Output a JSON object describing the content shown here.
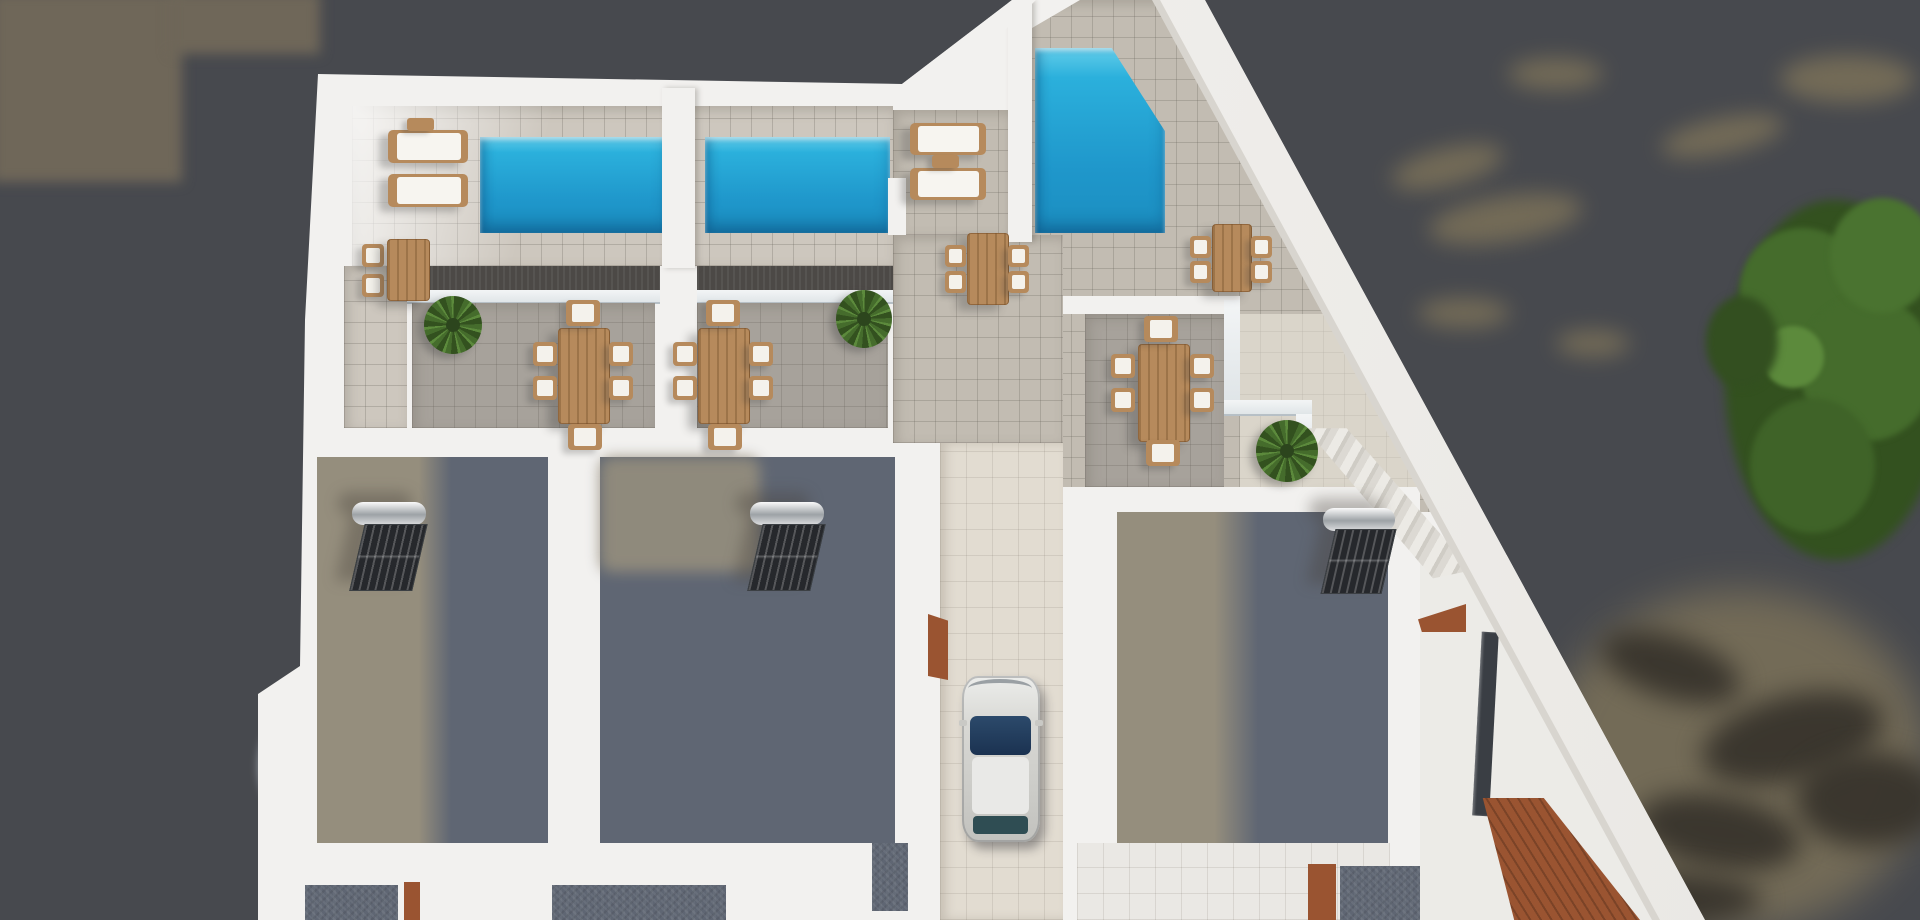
{
  "meta": {
    "title": "Aerial 3D architectural render of twin villas with rooftop pools, sun terraces, roof rooms with solar water heaters, a driveway with a parked car, and trees beside the plot",
    "width": 1920,
    "height": 920
  },
  "palette": {
    "ground": "#47494e",
    "ground_olive": "#6f6759",
    "shadow_blob": "#35312a",
    "olive_blob": "#7b7159",
    "wall": "#f2f1ef",
    "tile_light": "#cdc7be",
    "tile_mid": "#c2bcb2",
    "tile_gray": "#a7a29b",
    "tile_cream": "#e2dcd1",
    "tile_offwhite": "#eae8e4",
    "parapet": "#4c4946",
    "pool_hi": "#62cdea",
    "pool_mid": "#2bb0dc",
    "pool_deep": "#1f97cb",
    "gravel_lit": "#958e7d",
    "gravel_shadow": "#5f6673",
    "wood": "#b68a5c",
    "deck_brown": "#9a5431",
    "green_dark": "#33511f",
    "green_mid": "#456c2c",
    "green_light": "#5c8a3c",
    "car_body": "#d4d4d0",
    "car_glass": "#24415e",
    "sliver": "#3a3e44"
  },
  "scene": {
    "summary": {
      "pools": 3,
      "sun_loungers": 4,
      "dining_tables_six_seat": 3,
      "dining_tables_four_seat": 2,
      "bistro_sets": 1,
      "solar_water_heaters": 3,
      "cars": 1,
      "potted_palms": 3,
      "tree_cluster": "right edge of image"
    },
    "furniture_items": [
      {
        "type": "lounger",
        "x": 388,
        "y": 130,
        "w": 80,
        "h": 33
      },
      {
        "type": "lounger",
        "x": 388,
        "y": 174,
        "w": 80,
        "h": 33
      },
      {
        "type": "lounger",
        "x": 910,
        "y": 123,
        "w": 76,
        "h": 32
      },
      {
        "type": "lounger",
        "x": 910,
        "y": 168,
        "w": 76,
        "h": 32
      },
      {
        "type": "side-table",
        "x": 407,
        "y": 118,
        "w": 27,
        "h": 13
      },
      {
        "type": "side-table",
        "x": 932,
        "y": 155,
        "w": 27,
        "h": 13
      },
      {
        "type": "chair",
        "x": 362,
        "y": 244,
        "w": 22,
        "h": 23
      },
      {
        "type": "chair",
        "x": 362,
        "y": 274,
        "w": 22,
        "h": 23
      },
      {
        "type": "table-wood",
        "x": 387,
        "y": 239,
        "w": 41,
        "h": 60
      },
      {
        "type": "table-wood",
        "x": 967,
        "y": 233,
        "w": 40,
        "h": 70
      },
      {
        "type": "chair",
        "x": 945,
        "y": 245,
        "w": 21,
        "h": 22
      },
      {
        "type": "chair",
        "x": 945,
        "y": 271,
        "w": 21,
        "h": 22
      },
      {
        "type": "chair",
        "x": 1008,
        "y": 245,
        "w": 21,
        "h": 22
      },
      {
        "type": "chair",
        "x": 1008,
        "y": 271,
        "w": 21,
        "h": 22
      },
      {
        "type": "table-wood",
        "x": 1212,
        "y": 224,
        "w": 38,
        "h": 66
      },
      {
        "type": "chair",
        "x": 1190,
        "y": 236,
        "w": 21,
        "h": 22
      },
      {
        "type": "chair",
        "x": 1190,
        "y": 261,
        "w": 21,
        "h": 22
      },
      {
        "type": "chair",
        "x": 1251,
        "y": 236,
        "w": 21,
        "h": 22
      },
      {
        "type": "chair",
        "x": 1251,
        "y": 261,
        "w": 21,
        "h": 22
      },
      {
        "type": "table-wood",
        "x": 558,
        "y": 328,
        "w": 50,
        "h": 94
      },
      {
        "type": "chair",
        "x": 566,
        "y": 300,
        "w": 34,
        "h": 26
      },
      {
        "type": "chair",
        "x": 568,
        "y": 424,
        "w": 34,
        "h": 26
      },
      {
        "type": "chair",
        "x": 533,
        "y": 342,
        "w": 24,
        "h": 24
      },
      {
        "type": "chair",
        "x": 533,
        "y": 376,
        "w": 24,
        "h": 24
      },
      {
        "type": "chair",
        "x": 609,
        "y": 342,
        "w": 24,
        "h": 24
      },
      {
        "type": "chair",
        "x": 609,
        "y": 376,
        "w": 24,
        "h": 24
      },
      {
        "type": "table-wood",
        "x": 698,
        "y": 328,
        "w": 50,
        "h": 94
      },
      {
        "type": "chair",
        "x": 706,
        "y": 300,
        "w": 34,
        "h": 26
      },
      {
        "type": "chair",
        "x": 708,
        "y": 424,
        "w": 34,
        "h": 26
      },
      {
        "type": "chair",
        "x": 673,
        "y": 342,
        "w": 24,
        "h": 24
      },
      {
        "type": "chair",
        "x": 673,
        "y": 376,
        "w": 24,
        "h": 24
      },
      {
        "type": "chair",
        "x": 749,
        "y": 342,
        "w": 24,
        "h": 24
      },
      {
        "type": "chair",
        "x": 749,
        "y": 376,
        "w": 24,
        "h": 24
      },
      {
        "type": "table-wood",
        "x": 1138,
        "y": 344,
        "w": 50,
        "h": 96
      },
      {
        "type": "chair",
        "x": 1144,
        "y": 316,
        "w": 34,
        "h": 26
      },
      {
        "type": "chair",
        "x": 1146,
        "y": 440,
        "w": 34,
        "h": 26
      },
      {
        "type": "chair",
        "x": 1111,
        "y": 354,
        "w": 24,
        "h": 24
      },
      {
        "type": "chair",
        "x": 1111,
        "y": 388,
        "w": 24,
        "h": 24
      },
      {
        "type": "chair",
        "x": 1190,
        "y": 354,
        "w": 24,
        "h": 24
      },
      {
        "type": "chair",
        "x": 1190,
        "y": 388,
        "w": 24,
        "h": 24
      },
      {
        "type": "plant",
        "x": 424,
        "y": 296,
        "w": 58,
        "h": 58
      },
      {
        "type": "plant",
        "x": 836,
        "y": 290,
        "w": 56,
        "h": 58
      },
      {
        "type": "plant",
        "x": 1256,
        "y": 420,
        "w": 62,
        "h": 62
      },
      {
        "type": "solar-heater",
        "x": 352,
        "y": 502,
        "w": 74,
        "h": 86
      },
      {
        "type": "solar-heater",
        "x": 750,
        "y": 502,
        "w": 74,
        "h": 86
      },
      {
        "type": "solar-heater",
        "x": 1323,
        "y": 508,
        "w": 72,
        "h": 84
      }
    ]
  }
}
